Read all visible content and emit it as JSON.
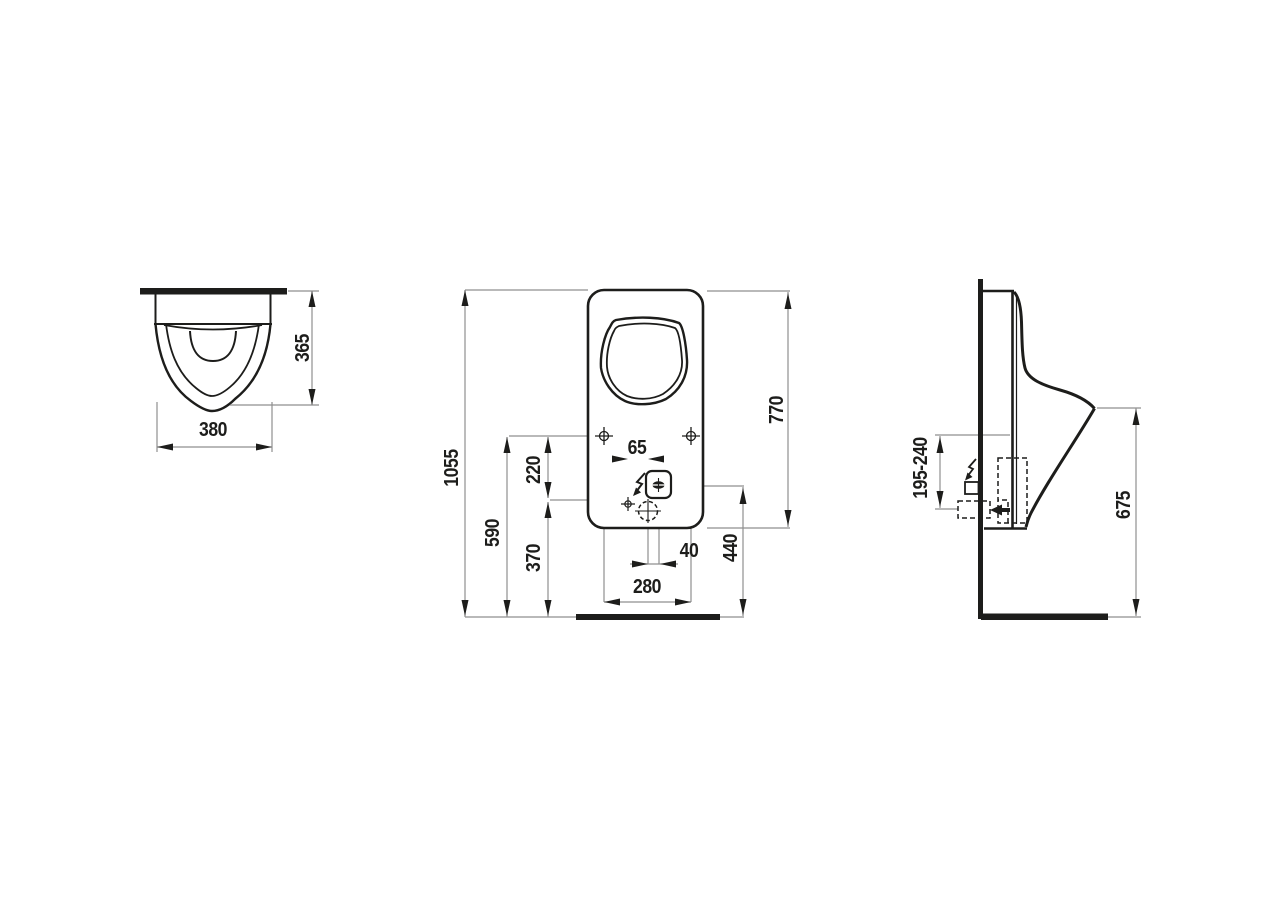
{
  "drawing": {
    "type": "technical-dimension-drawing",
    "subject": "wall-hung-urinal",
    "colors": {
      "background": "#ffffff",
      "line": "#1d1d1b",
      "dim_line": "#8f8f8f"
    },
    "views": {
      "top": {
        "dims": {
          "width": "380",
          "depth": "365"
        }
      },
      "front": {
        "dims": {
          "total_height": "1055",
          "fixing_height": "590",
          "d220": "220",
          "d370": "370",
          "d65": "65",
          "d40": "40",
          "fixing_spacing": "280",
          "d440": "440",
          "body_height": "770"
        }
      },
      "side": {
        "dims": {
          "supply_range": "195-240",
          "lip_height": "675"
        }
      }
    },
    "icons": {
      "front_electrical": "lightning-bolt",
      "side_electrical": "lightning-bolt",
      "water_inlet": "left-arrow"
    }
  }
}
